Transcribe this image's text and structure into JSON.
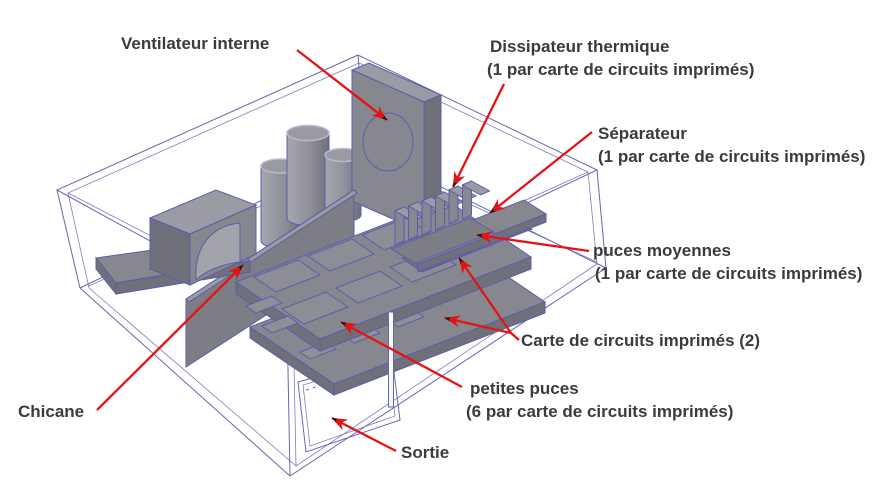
{
  "colors": {
    "background": "#ffffff",
    "wireframe": "#6767b2",
    "component_fill": "#87878f",
    "component_dark": "#70707a",
    "component_light": "#9b9ba3",
    "component_outline": "#5c5cae",
    "arrow_red": "#e41414",
    "label_text": "#3b3b3b"
  },
  "labels": {
    "fan": {
      "line1": "Ventilateur interne"
    },
    "heatsink": {
      "line1": "Dissipateur thermique",
      "line2": "(1 par carte de circuits imprimés)"
    },
    "separator": {
      "line1": "Séparateur",
      "line2": "(1 par carte de circuits imprimés)"
    },
    "medium_chips": {
      "line1": "puces moyennes",
      "line2": "(1 par carte de circuits imprimés)"
    },
    "pcb": {
      "line1": "Carte de circuits imprimés (2)"
    },
    "small_chips": {
      "line1": "petites puces",
      "line2": "(6 par carte de circuits imprimés)"
    },
    "baffle": {
      "line1": "Chicane"
    },
    "outlet": {
      "line1": "Sortie"
    }
  }
}
